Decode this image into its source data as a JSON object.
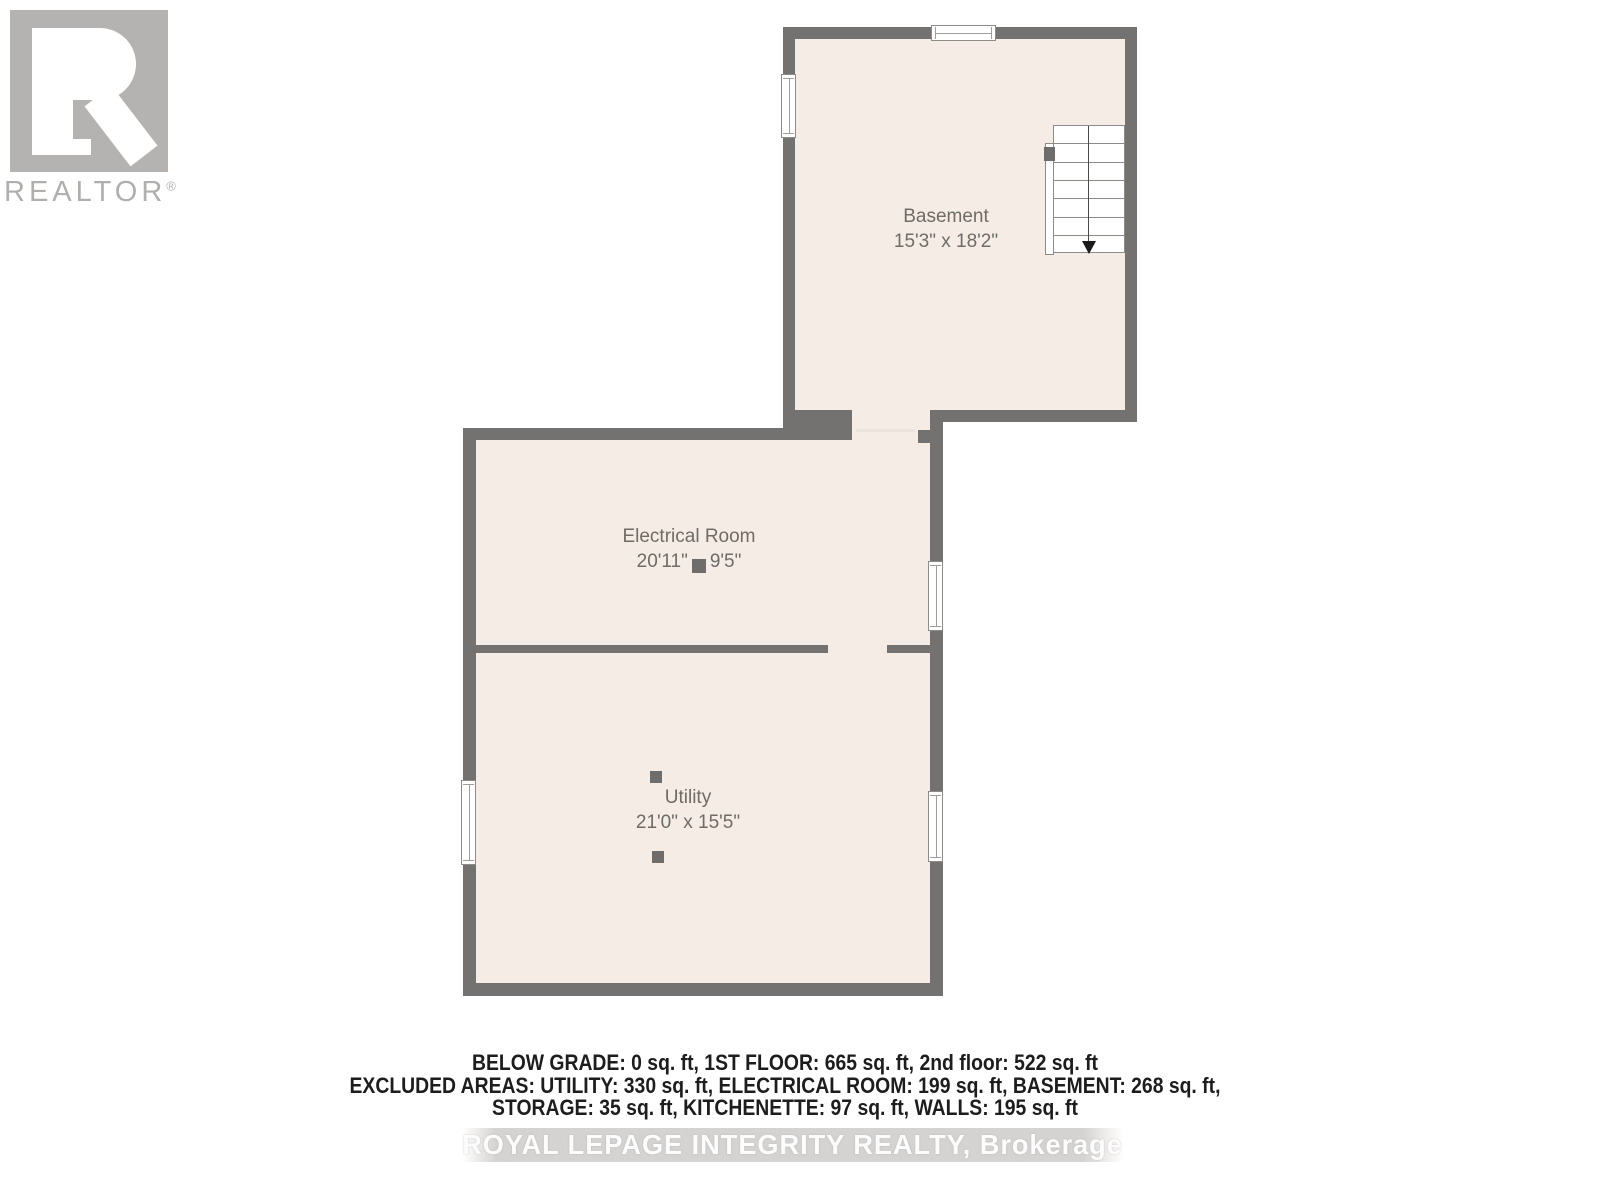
{
  "branding": {
    "logo_text": "REALTOR",
    "registered": "®"
  },
  "rooms": {
    "basement": {
      "name": "Basement",
      "dims": "15'3\" x 18'2\""
    },
    "electrical": {
      "name": "Electrical Room",
      "dim_a": "20'11\"",
      "dim_b": "9'5\""
    },
    "utility": {
      "name": "Utility",
      "dims": "21'0\" x 15'5\""
    }
  },
  "footer": {
    "line1": "BELOW GRADE: 0 sq. ft, 1ST FLOOR: 665 sq. ft, 2nd floor: 522 sq. ft",
    "line2": "EXCLUDED AREAS: UTILITY: 330 sq. ft, ELECTRICAL ROOM: 199 sq. ft, BASEMENT: 268 sq. ft,",
    "line3": "STORAGE: 35 sq. ft, KITCHENETTE: 97 sq. ft, WALLS: 195 sq. ft"
  },
  "watermark": {
    "text": "ROYAL LEPAGE INTEGRITY REALTY, Brokerage"
  },
  "colors": {
    "wall": "#747270",
    "floor": "#f5ece5",
    "label_text": "#6f6b67",
    "footer_text": "#1d1d1d",
    "logo_gray": "#b5b3b2",
    "watermark_band": "#d5d3d1",
    "window_frame": "#8d8b87"
  }
}
